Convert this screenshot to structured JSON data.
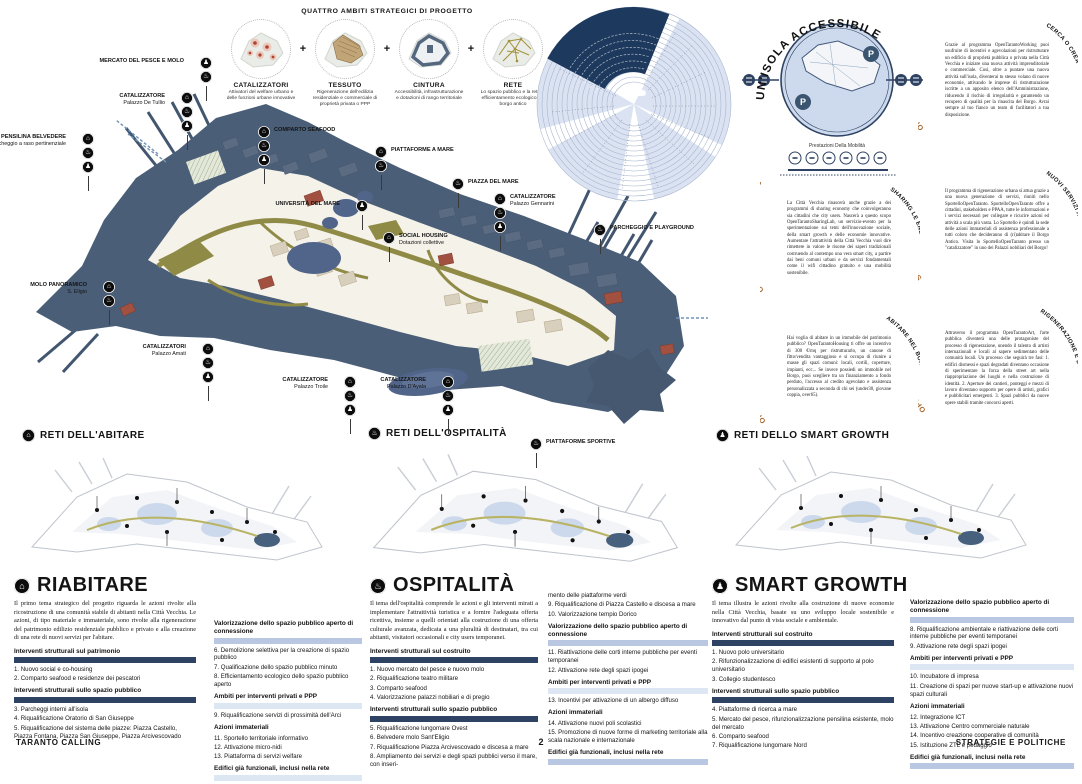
{
  "poster": {
    "footer_left": "TARANTO CALLING",
    "page_number": "2",
    "footer_right": "STRATEGIE E POLITICHE"
  },
  "quattro_ambiti": {
    "title": "QUATTRO AMBITI STRATEGICI DI PROGETTO",
    "plus": "+",
    "items": [
      {
        "name": "CATALIZZATORI",
        "caption": "Attivatori del welfare urbano e delle funzioni urbane innovative",
        "icon": "catalysts-dots-icon"
      },
      {
        "name": "TESSUTO",
        "caption": "Rigenerazione dell'edilizia residenziale e commerciale di proprietà privata o PPP",
        "icon": "urban-fabric-icon"
      },
      {
        "name": "CINTURA",
        "caption": "Accessibilità, infrastrutturazione e dotazioni di rango territoriale",
        "icon": "belt-outline-icon"
      },
      {
        "name": "RETE",
        "caption": "Lo spazio pubblico e la rete di efficientamento ecologico del borgo antico",
        "icon": "network-lines-icon"
      }
    ]
  },
  "map_markers": [
    {
      "label": "MERCATO DEL PESCE E MOLO",
      "sub": "",
      "x": 200,
      "y": 57,
      "side": "left",
      "icons": [
        "smart",
        "ospitalita"
      ]
    },
    {
      "label": "CATALIZZATORE",
      "sub": "Palazzo De Tullio",
      "x": 181,
      "y": 92,
      "side": "left",
      "icons": [
        "abitare",
        "ospitalita",
        "smart"
      ]
    },
    {
      "label": "PENSILINA BELVEDERE",
      "sub": "+ parcheggio a raso pertinenziale",
      "x": 82,
      "y": 133,
      "side": "left",
      "icons": [
        "abitare",
        "ospitalita",
        "smart"
      ]
    },
    {
      "label": "COMPARTO SEAFOOD",
      "sub": "",
      "x": 258,
      "y": 126,
      "side": "right",
      "icons": [
        "abitare",
        "ospitalita",
        "smart"
      ]
    },
    {
      "label": "PIATTAFORME A MARE",
      "sub": "",
      "x": 375,
      "y": 146,
      "side": "right",
      "icons": [
        "abitare",
        "ospitalita"
      ]
    },
    {
      "label": "PIAZZA DEL MARE",
      "sub": "",
      "x": 452,
      "y": 178,
      "side": "right",
      "icons": [
        "ospitalita"
      ]
    },
    {
      "label": "UNIVERSITÀ DEL MARE",
      "sub": "",
      "x": 356,
      "y": 200,
      "side": "left",
      "icons": [
        "smart"
      ]
    },
    {
      "label": "SOCIAL HOUSING",
      "sub": "Dotazioni collettive",
      "x": 383,
      "y": 232,
      "side": "right",
      "icons": [
        "abitare"
      ]
    },
    {
      "label": "CATALIZZATORE",
      "sub": "Palazzo Gennarini",
      "x": 494,
      "y": 193,
      "side": "right",
      "icons": [
        "abitare",
        "ospitalita",
        "smart"
      ]
    },
    {
      "label": "PARCHEGGIO E PLAYGROUND",
      "sub": "",
      "x": 594,
      "y": 224,
      "side": "right",
      "icons": [
        "ospitalita"
      ]
    },
    {
      "label": "MOLO PANORAMICO",
      "sub": "S. Eligio",
      "x": 103,
      "y": 281,
      "side": "left",
      "icons": [
        "abitare",
        "ospitalita"
      ]
    },
    {
      "label": "CATALIZZATORI",
      "sub": "Palazzo Amati",
      "x": 202,
      "y": 343,
      "side": "left",
      "icons": [
        "abitare",
        "ospitalita",
        "smart"
      ]
    },
    {
      "label": "CATALIZZATORE",
      "sub": "Palazzo Troile",
      "x": 344,
      "y": 376,
      "side": "left",
      "icons": [
        "abitare",
        "ospitalita",
        "smart"
      ]
    },
    {
      "label": "CATALIZZATORE",
      "sub": "Palazzo D'Ayala",
      "x": 442,
      "y": 376,
      "side": "left",
      "icons": [
        "abitare",
        "ospitalita",
        "smart"
      ]
    },
    {
      "label": "PIATTAFORME SPORTIVE",
      "sub": "",
      "x": 530,
      "y": 438,
      "side": "right",
      "icons": [
        "ospitalita"
      ]
    }
  ],
  "accessibility": {
    "title": "UN'ISOLA ACCESSIBILE",
    "caption": "Prestazioni Della Mobilità",
    "parking_label": "P",
    "mobility_icons": [
      "pedestrian-icon",
      "bike-icon",
      "scooter-icon",
      "bus-icon",
      "car-icon",
      "train-icon"
    ]
  },
  "program_blocks": [
    {
      "curved_title": "OPENTARANTOWORKING",
      "side_label": "CERCA O CREA",
      "body": "Grazie al programma OpenTarantoWorking puoi usufruire di incentivi e agevolazioni per ristrutturare un edificio di proprietà pubblica o privata nella Città Vecchia e iniziare una nuova attività imprenditoriale o commerciale. Così, oltre a puntare una nuova attività sull'isola, diventerai tu stesso volano di nuove economie, attivando le imprese di ristrutturazione iscritte a un apposito elenco dell'Amministrazione, riducendo il rischio di irregolarità e garantendo un recupero di qualità per la rinascita del Borgo. Avrai sempre al tuo fianco un team di facilitatori a tua disposizione."
    },
    {
      "curved_title": "OPENTARANTOSHARINGLAB",
      "side_label": "SHARING LE ENERGIE",
      "body": "La Città Vecchia rinascerà anche grazie a dei programmi di sharing economy che coinvolgeranno sia cittadini che city users. Nascerà a questo scopo OpenTarantoSharingLab, un servizio-evento per la sperimentazione sui temi dell'innovazione sociale, della smart growth e delle economie innovative. Aumentare l'attrattività della Città Vecchia vuol dire rimettere in valore le risorse dei saperi tradizionali costruendo al contempo una vera smart city, a partire dai beni comuni urbani e da servizi fondamentali come il wifi cittadino gratuito e una mobilità sostenibile."
    },
    {
      "curved_title": "SPORTELLOOPENTARANTO",
      "side_label": "NUOVI SERVIZI A DISPOSIZIONE",
      "body": "Il programma di rigenerazione urbana si attua grazie a una nuova generazione di servizi, riuniti nello SportelloOpenTaranto. SportelloOpenTaranto offre a cittadini, stakeholders e PPAA, tutte le informazioni e i servizi necessari per collegare e ricucire azioni ed attività a scala più vasta. Lo Sportello è quindi la sede delle azioni immateriali di assistenza professionale a tutti coloro che decideranno di (ri)abitare il Borgo Antico. Visita lo SportelloOpenTaranto presso un \"catalizzatore\" in uno dei Palazzi nobiliari del Borgo!"
    },
    {
      "curved_title": "OPENTARANTOHOUSING",
      "side_label": "ABITARE NEL BORGO ANTICO",
      "body": "Hai voglia di abitare in un immobile del patrimonio pubblico? OpenTarantoHousing ti offre un incentivo di 300 €/mq per ristrutturarlo, un canone di fitto/vendita vantaggioso e si occupa di riunire a masse gli spazi comuni: locali, cortili, coperture, impianti, ecc... Se invece possiedi un immobile nel Borgo, puoi scegliere tra un finanziamento a fondo perduto, l'accesso al credito agevolato e assistenza personalizzata a seconda di chi sei (under30, giovane coppia, over65)."
    },
    {
      "curved_title": "OPENTARANTOART",
      "side_label": "RIGENERAZIONE E D'ARTE",
      "body": "Attraverso il programma OpenTarantoArt, l'arte pubblica diventerà una delle protagoniste del processo di rigenerazione, unendo il talento di artisti internazionali e locali al sapere sedimentato delle comunità locali. Un processo che seguirà tre fasi: 1. edifici dismessi e spazi degradati diventano occasione di sperimentare la forza della street art nella riappropriazione dei luoghi e nella costruzione di identità. 2. Aperture dei cantieri, ponteggi e mezzi di lavoro diventano supporto per opere di artisti, grafici e pubblicitari emergenti. 3. Spazi pubblici da nuove opere stabili tramite concorsi aperti."
    }
  ],
  "network_maps": [
    {
      "title": "RETI DELL'ABITARE",
      "icon": "abitare"
    },
    {
      "title": "RETI DELL'OSPITALITÀ",
      "icon": "ospitalita"
    },
    {
      "title": "RETI DELLO SMART GROWTH",
      "icon": "smart"
    }
  ],
  "sections": [
    {
      "title": "RIABITARE",
      "icon": "abitare",
      "intro": "Il primo tema strategico del progetto riguarda le azioni rivolte alla ricostruzione di una comunità stabile di abitanti nella Città Vecchia. Le azioni, di tipo materiale e immateriale, sono rivolte alla rigenerazione del patrimonio edilizio residenziale pubblico e privato e alla creazione di una rete di nuovi servizi per l'abitare.",
      "col1": [
        {
          "h": "Interventi strutturali sul patrimonio",
          "bar": "dark"
        },
        {
          "items": [
            "1. Nuovo social e co-housing",
            "2. Comparto seafood e residenze dei pescatori"
          ]
        },
        {
          "h": "Interventi strutturali sullo spazio pubblico",
          "bar": "dark"
        },
        {
          "items": [
            "3. Parcheggi interni all'isola",
            "4. Riqualificazione Oratorio di San Giuseppe",
            "5. Riqualificazione del sistema delle piazze: Piazza Castello, Piazza Fontana, Piazza San Giuseppe, Piazza Arcivescovado"
          ]
        }
      ],
      "col2": [
        {
          "h": "Valorizzazione dello spazio pubblico aperto di connessione",
          "bar": "light"
        },
        {
          "items": [
            "6. Demolizione selettiva per la creazione di spazio pubblico",
            "7. Qualificazione dello spazio pubblico minuto",
            "8. Efficientamento ecologico dello spazio pubblico aperto"
          ]
        },
        {
          "h": "Ambiti per interventi privati e PPP",
          "bar": "pale"
        },
        {
          "items": [
            "9. Riqualificazione servizi di prossimità dell'Arci"
          ]
        },
        {
          "h": "Azioni immateriali",
          "bar": "none"
        },
        {
          "items": [
            "11. Sportello territoriale informativo",
            "12. Attivazione micro-nidi",
            "13. Piattaforma di servizi welfare"
          ]
        },
        {
          "h": "Edifici già funzionali, inclusi nella rete",
          "bar": "pale"
        }
      ]
    },
    {
      "title": "OSPITALITÀ",
      "icon": "ospitalita",
      "intro": "Il tema dell'ospitalità comprende le azioni e gli interventi mirati a implementare l'attrattività turistica e a fornire l'adeguata offerta ricettiva, insieme a quelli orientati alla costruzione di una offerta culturale avanzata, dedicata a una pluralità di destinatari, tra cui abitanti, visitatori occasionali e city users temporanei.",
      "col1": [
        {
          "h": "Interventi strutturali sul costruito",
          "bar": "dark"
        },
        {
          "items": [
            "1. Nuovo mercato del pesce e nuovo molo",
            "2. Riqualificazione teatro militare",
            "3. Comparto seafood",
            "4. Valorizzazione palazzi nobiliari e di pregio"
          ]
        },
        {
          "h": "Interventi strutturali sullo spazio pubblico",
          "bar": "dark"
        },
        {
          "items": [
            "5. Riqualificazione lungomare Ovest",
            "6. Belvedere molo Sant'Eligio",
            "7. Riqualificazione Piazza Arcivescovado e discesa a mare",
            "8. Ampliamento dei servizi e degli spazi pubblici verso il mare, con inseri-"
          ]
        }
      ],
      "col2": [
        {
          "items": [
            "mento delle piattaforme verdi",
            "9. Riqualificazione di Piazza Castello e discesa a mare",
            "10. Valorizzazione tempio Dorico"
          ]
        },
        {
          "h": "Valorizzazione dello spazio pubblico aperto di connessione",
          "bar": "light"
        },
        {
          "items": [
            "11. Riattivazione delle corti interne pubbliche per eventi temporanei",
            "12. Attivazione rete degli spazi ipogei"
          ]
        },
        {
          "h": "Ambiti per interventi privati e PPP",
          "bar": "pale"
        },
        {
          "items": [
            "13. Incentivi per attivazione di un albergo diffuso"
          ]
        },
        {
          "h": "Azioni immateriali",
          "bar": "none"
        },
        {
          "items": [
            "14. Attivazione nuovi poli scolastici",
            "15. Promozione di nuove forme di marketing territoriale alla scala nazionale e internazionale"
          ]
        },
        {
          "h": "Edifici già funzionali, inclusi nella rete",
          "bar": "light"
        }
      ]
    },
    {
      "title": "SMART GROWTH",
      "icon": "smart",
      "intro": "Il tema illustra le azioni rivolte alla costruzione di nuove economie nella Città Vecchia, basate su uno sviluppo locale sostenibile e innovativo dal punto di vista sociale e ambientale.",
      "col1": [
        {
          "h": "Interventi strutturali sul costruito",
          "bar": "dark"
        },
        {
          "items": [
            "1. Nuovo polo universitario",
            "2. Rifunzionalizzazione di edifici esistenti di supporto al polo universitario",
            "3. Collegio studentesco"
          ]
        },
        {
          "h": "Interventi strutturali sullo spazio pubblico",
          "bar": "dark"
        },
        {
          "items": [
            "4. Piattaforme di ricerca a mare",
            "5. Mercato del pesce, rifunzionalizzazione pensilina esistente, molo del mercato",
            "6. Comparto seafood",
            "7. Riqualificazione lungomare Nord"
          ]
        }
      ],
      "col2": [
        {
          "h": "Valorizzazione dello spazio pubblico aperto di connessione",
          "bar": "light"
        },
        {
          "items": [
            "8. Riqualificazione ambientale e riattivazione delle corti interne pubbliche per eventi temporanei",
            "9. Attivazione rete degli spazi ipogei"
          ]
        },
        {
          "h": "Ambiti per interventi privati e PPP",
          "bar": "pale"
        },
        {
          "items": [
            "10. Incubatore di impresa",
            "11. Creazione di spazi per nuove start-up e attivazione nuovi spazi culturali"
          ]
        },
        {
          "h": "Azioni immateriali",
          "bar": "none"
        },
        {
          "items": [
            "12. Integrazione ICT",
            "13. Attivazione Centro commerciale naturale",
            "14. Incentivo creazione cooperative di comunità",
            "15. Istituzione ZTL e pedaggio"
          ]
        },
        {
          "h": "Edifici già funzionali, inclusi nella rete",
          "bar": "light"
        }
      ]
    }
  ],
  "colors": {
    "navy": "#2e4263",
    "slate_island": "#4a5e77",
    "light_blue": "#b9c7e3",
    "pale_blue": "#dde6f3",
    "olive": "#8f8a45",
    "terracotta": "#a25140",
    "orange_title": "#a9672f"
  }
}
